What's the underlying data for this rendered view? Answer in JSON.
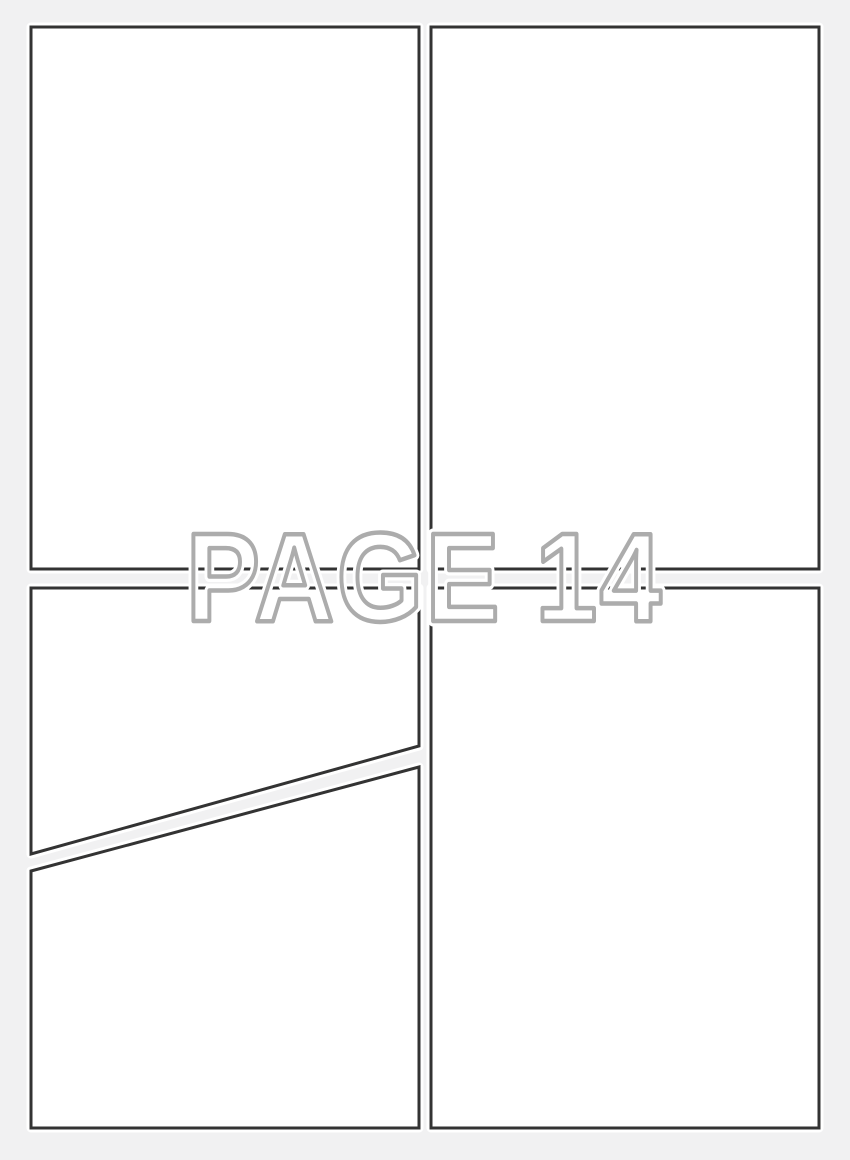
{
  "watermark": {
    "label": "PAGE 14"
  },
  "panels": {
    "count": 4,
    "layout": "2x2 grid, bottom-left panel split by a diagonal gutter",
    "names": [
      "panel-top-left",
      "panel-top-right",
      "panel-bottom-left-upper",
      "panel-bottom-left-lower",
      "panel-bottom-right"
    ]
  },
  "colors": {
    "background": "#f1f1f2",
    "panel_fill": "#ffffff",
    "panel_border": "#333333",
    "watermark_outline": "#a8a8a8",
    "watermark_halo": "#ffffff"
  }
}
